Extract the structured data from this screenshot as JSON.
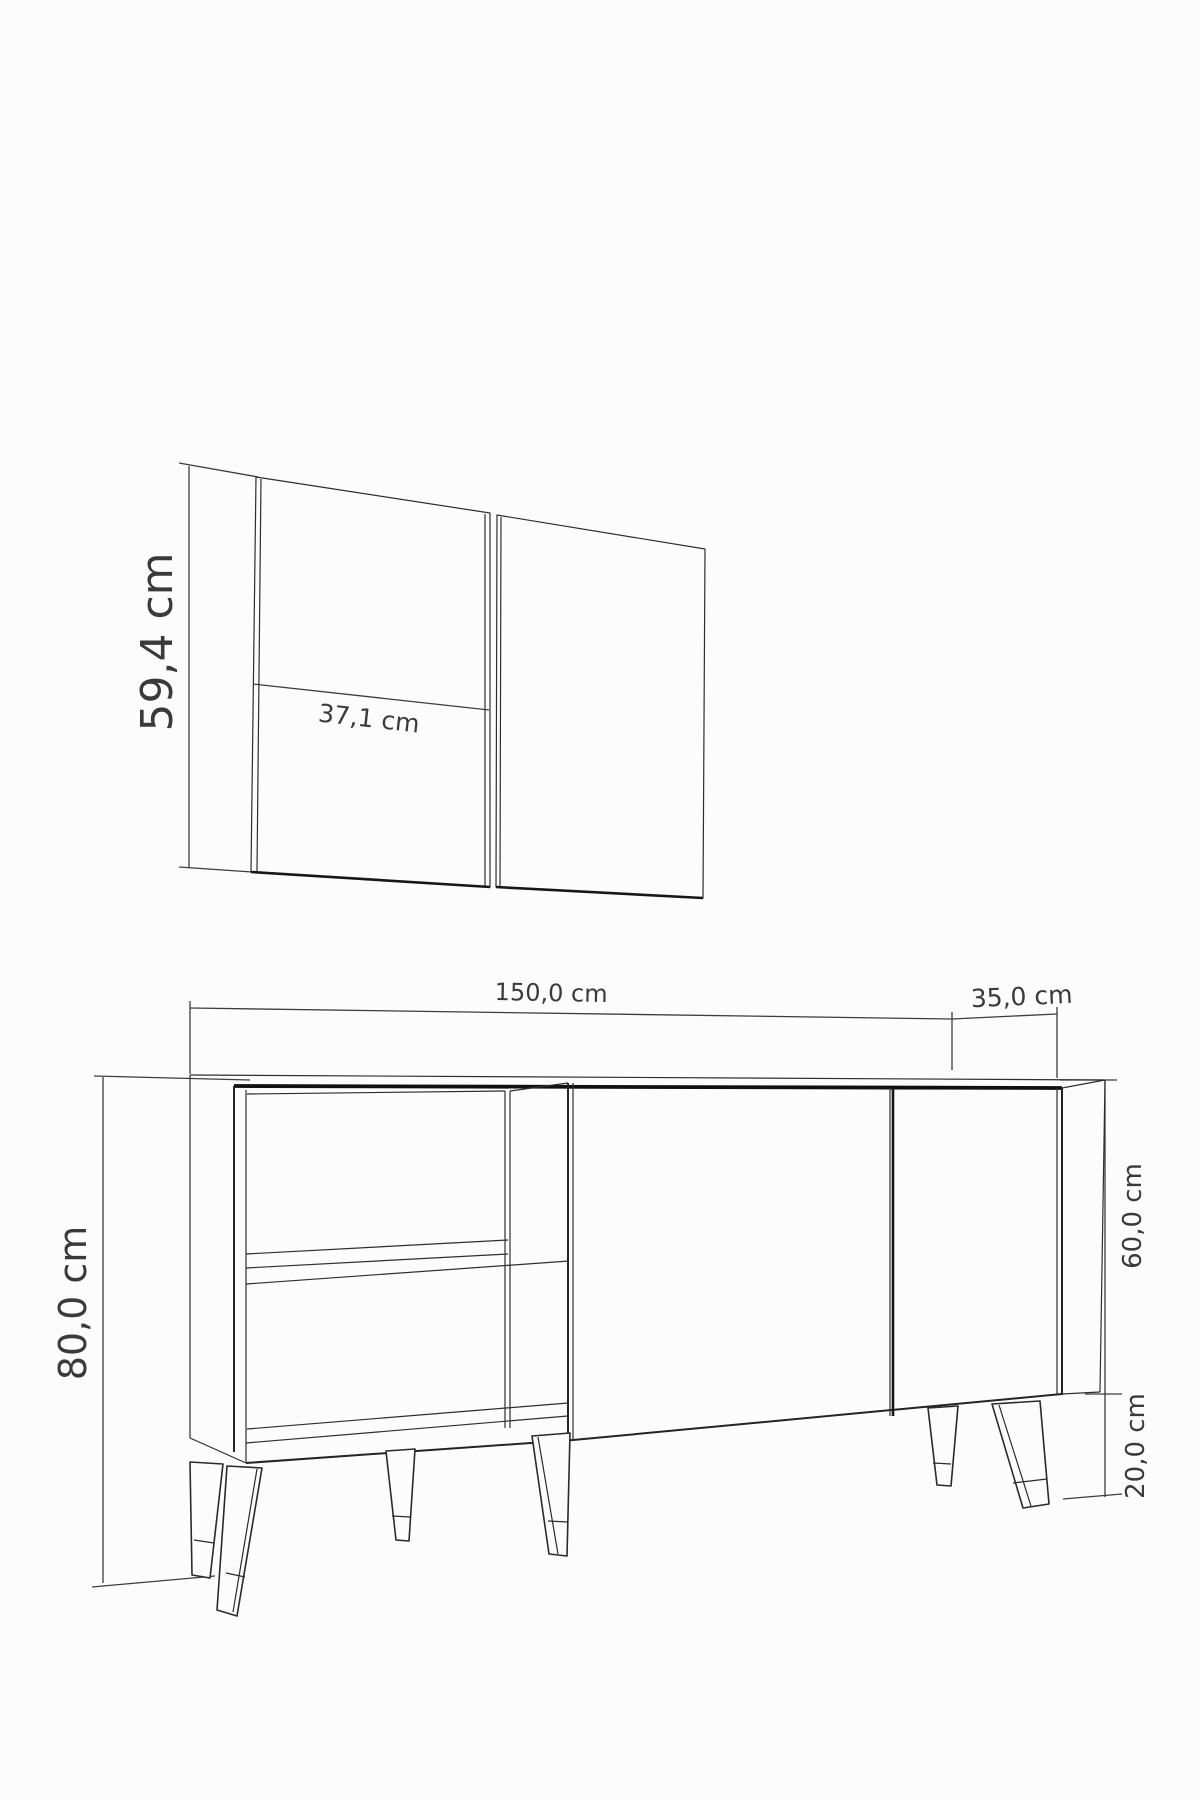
{
  "drawing": {
    "background": "#fcfcfc",
    "line_color": "#2e2e2e",
    "heavy_line_color": "#101010",
    "text_color": "#3a3a3a",
    "annotations": {
      "panel_height": "59,4 cm",
      "panel_width": "37,1 cm",
      "cabinet_width": "150,0 cm",
      "cabinet_depth": "35,0 cm",
      "cabinet_total_height": "80,0 cm",
      "carcass_height": "60,0 cm",
      "leg_height": "20,0 cm"
    }
  }
}
